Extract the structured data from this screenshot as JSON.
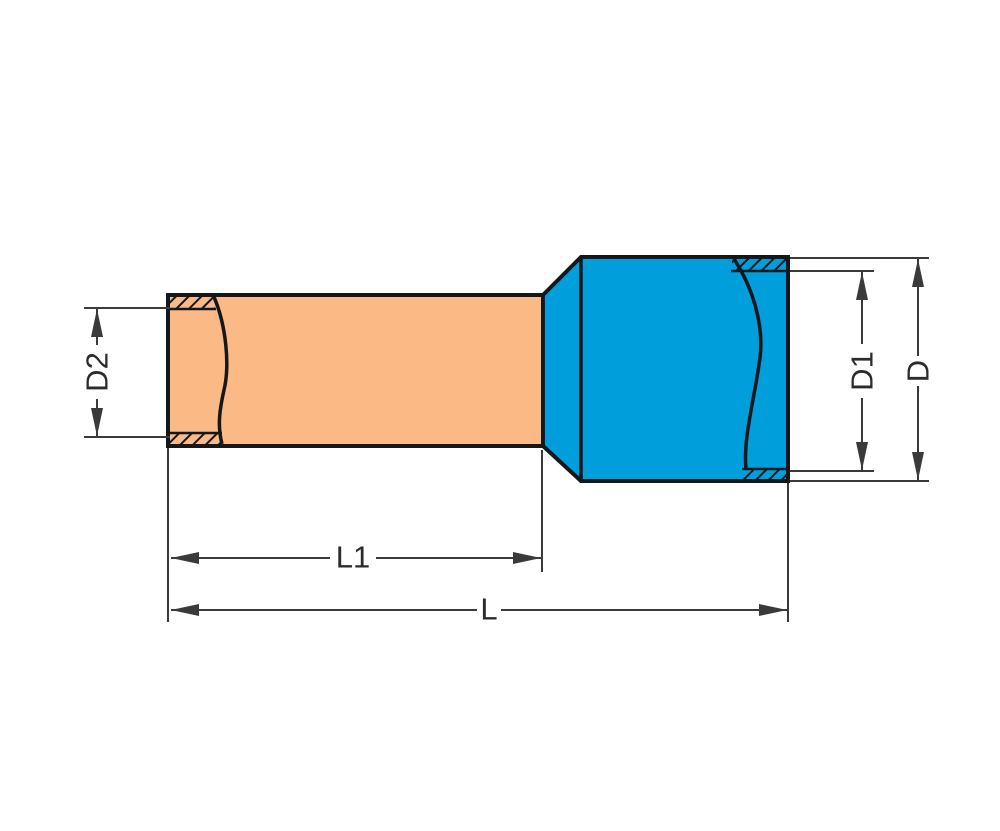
{
  "labels": {
    "d2": "D2",
    "d1": "D1",
    "d": "D",
    "l1": "L1",
    "l": "L"
  },
  "colors": {
    "copper_sleeve": "#FBB985",
    "insulation_blue": "#009FDB",
    "outline": "#15181B",
    "dimension": "#3A3A3A",
    "label_text": "#2B2B2B",
    "background": "#FFFFFF"
  }
}
